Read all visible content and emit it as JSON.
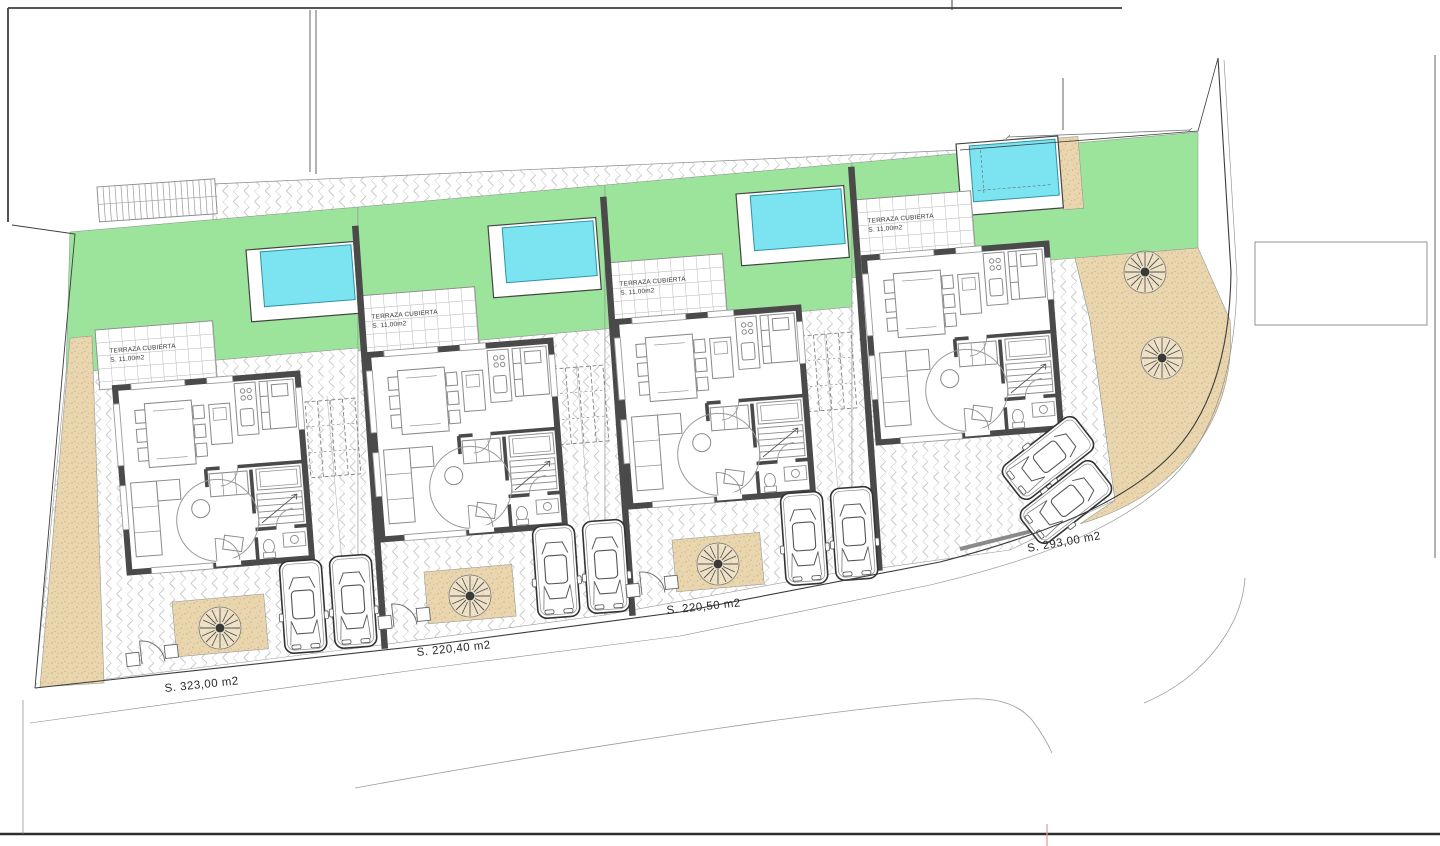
{
  "plots": [
    {
      "area_label": "S. 323,00 m2",
      "terrace_label": {
        "line1": "TERRAZA CUBIERTA",
        "line2": "S. 11,00m2"
      }
    },
    {
      "area_label": "S. 220,40 m2",
      "terrace_label": {
        "line1": "TERRAZA CUBIERTA",
        "line2": "S. 11,00m2"
      }
    },
    {
      "area_label": "S. 220,50 m2",
      "terrace_label": {
        "line1": "TERRAZA CUBIERTA",
        "line2": "S. 11,00m2"
      }
    },
    {
      "area_label": "S. 293,00 m2",
      "terrace_label": {
        "line1": "TERRAZA CUBIERTA",
        "line2": "S. 11,00m2"
      }
    }
  ],
  "colors": {
    "lawn": "#9ce49c",
    "pool_water": "#7ce3f0",
    "pool_edge": "#2e93a6",
    "sand": "#e9d6ae",
    "wall": "#4a4a4a"
  }
}
